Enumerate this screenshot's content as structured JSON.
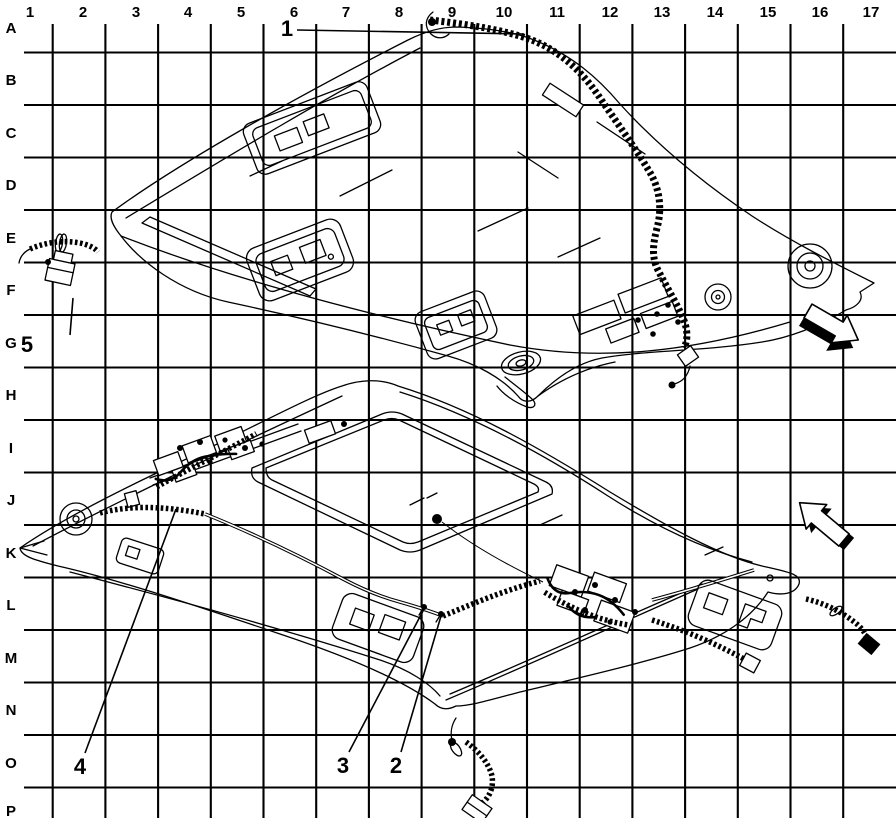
{
  "page": {
    "background": "#ffffff",
    "line_color": "#000000"
  },
  "grid": {
    "columns": [
      "1",
      "2",
      "3",
      "4",
      "5",
      "6",
      "7",
      "8",
      "9",
      "10",
      "11",
      "12",
      "13",
      "14",
      "15",
      "16",
      "17"
    ],
    "rows": [
      "A",
      "B",
      "C",
      "D",
      "E",
      "F",
      "G",
      "H",
      "I",
      "J",
      "K",
      "L",
      "M",
      "N",
      "O",
      "P"
    ]
  },
  "callouts": [
    {
      "id": "callout-1",
      "label": "1"
    },
    {
      "id": "callout-2",
      "label": "2"
    },
    {
      "id": "callout-3",
      "label": "3"
    },
    {
      "id": "callout-4",
      "label": "4"
    },
    {
      "id": "callout-5",
      "label": "5"
    }
  ],
  "figure": {
    "description": "Service-manual line illustration of a vehicle roof panel (top isometric view) and headliner (underside isometric view) with roof wiring-harness routing, shown over an alphanumeric reference grid",
    "views": [
      {
        "name": "roof-top-view"
      },
      {
        "name": "headliner-underside-view"
      }
    ],
    "direction_arrows": [
      {
        "name": "direction-arrow-lower-right"
      },
      {
        "name": "direction-arrow-upper-left"
      }
    ]
  }
}
